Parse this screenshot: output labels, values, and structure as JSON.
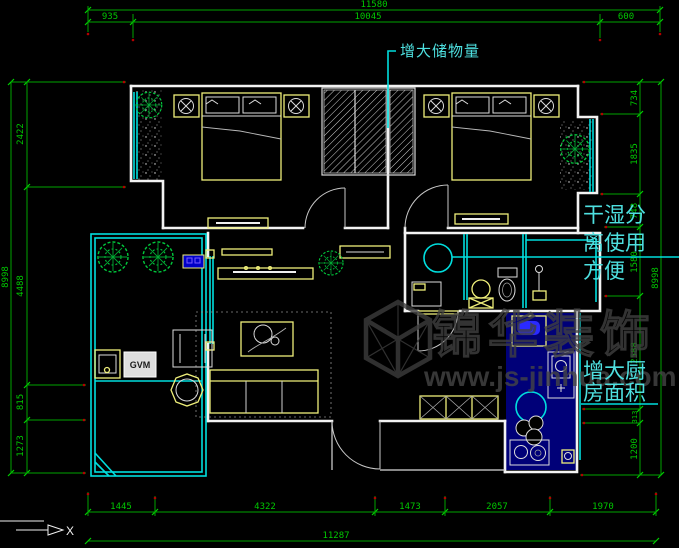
{
  "colors": {
    "background": "#000000",
    "dimension_green": "#00c800",
    "annotation_cyan": "#4ee0e0",
    "wall_white": "#f2f2f2",
    "furniture_yellow": "#efef7a",
    "window_cyan": "#00dede",
    "plant_green": "#00c83c",
    "kitchen_fill_navy": "#000078",
    "watermark_gray": "#404040",
    "marker_dot_red": "#b40000"
  },
  "dims": {
    "top_total": "11580",
    "top": [
      "935",
      "10045",
      "600"
    ],
    "bottom": [
      "1445",
      "4322",
      "1473",
      "2057",
      "1970"
    ],
    "bottom_total": "11287",
    "left": [
      "2422",
      "4488",
      "815",
      "1273"
    ],
    "left_total": "8998",
    "right": [
      "734",
      "1835",
      "748",
      "1580",
      "2588",
      "313",
      "1200"
    ],
    "right_total": "8998"
  },
  "notes": {
    "storage": "增大储物量",
    "drywet_line1": "干湿分",
    "drywet_line2": "离使用",
    "drywet_line3": "方便",
    "kitchen_line1": "增大厨",
    "kitchen_line2": "房面积"
  },
  "watermark": {
    "brand": "锦华装饰",
    "url": "www.js-jinhua.com"
  },
  "labels": {
    "appliance": "GVM",
    "axis_x": "X"
  }
}
